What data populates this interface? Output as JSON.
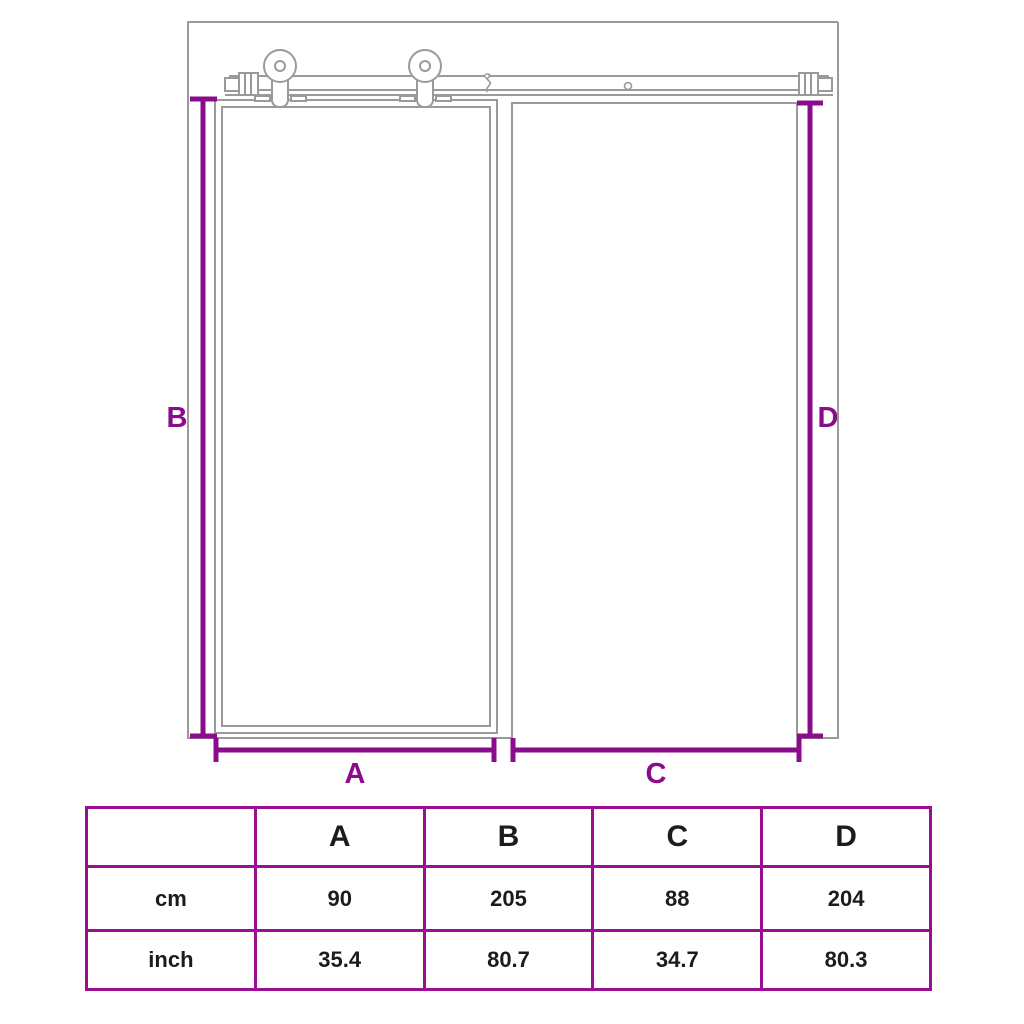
{
  "diagram": {
    "dimension_labels": {
      "a": "A",
      "b": "B",
      "c": "C",
      "d": "D"
    },
    "colors": {
      "dimension_purple": "#8A0C8A",
      "table_border_purple": "#9B0E93",
      "drawing_line_gray": "#9A9A9A",
      "text_color": "#1C1C1C"
    }
  },
  "table": {
    "corner_label": "",
    "headers": [
      "A",
      "B",
      "C",
      "D"
    ],
    "rows": [
      {
        "label": "cm",
        "values": [
          "90",
          "205",
          "88",
          "204"
        ]
      },
      {
        "label": "inch",
        "values": [
          "35.4",
          "80.7",
          "34.7",
          "80.3"
        ]
      }
    ]
  }
}
